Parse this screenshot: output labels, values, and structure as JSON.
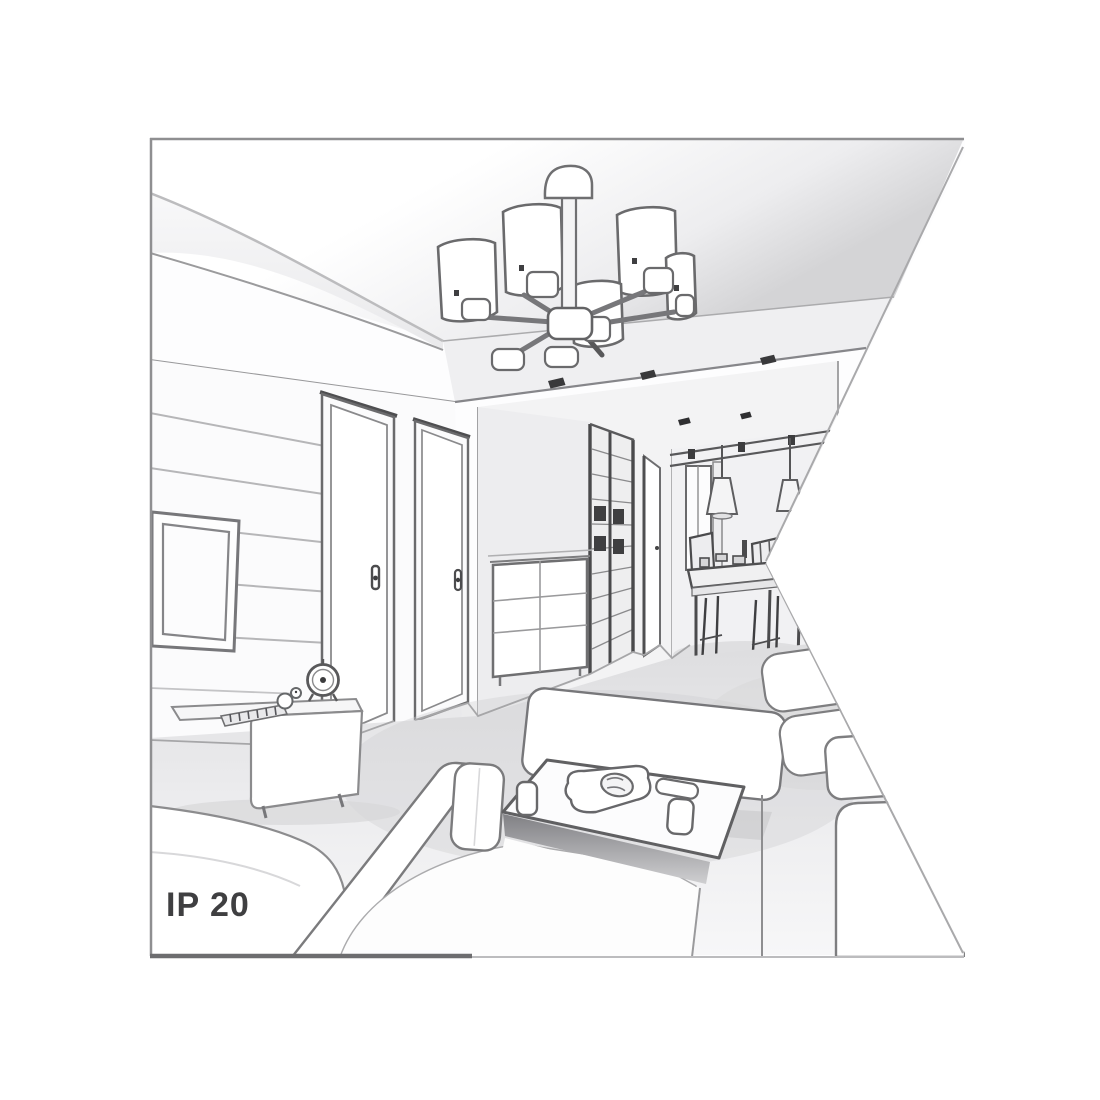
{
  "figure": {
    "ip_rating": "IP 20",
    "colors": {
      "background": "#ffffff",
      "frame_border": "#8f8f91",
      "sketch_line": "#6b6b6d",
      "dark_detail": "#3c3c3e",
      "wall_fill": "#fbfbfc",
      "soffit_gray": "#efeff1",
      "floor_gray": "#e4e4e6",
      "shadow_gray": "#c9c9cb",
      "label_text": "#3f3f41"
    },
    "scene_objects": [
      "ceiling-chandelier-five-shades",
      "tray-ceiling-spotlights",
      "wall-mounted-tv",
      "interior-door-left",
      "interior-door-right",
      "hallway-sliding-wardrobe",
      "chest-of-drawers",
      "pendant-cone-lamps",
      "dining-table-and-chairs",
      "tv-stand",
      "table-clock",
      "duck-figurine",
      "chaise-sofa",
      "sofa-backrest-cushion",
      "right-sofa-clipped",
      "coffee-table",
      "cups",
      "serving-plate-with-croissant",
      "remote-control"
    ]
  }
}
